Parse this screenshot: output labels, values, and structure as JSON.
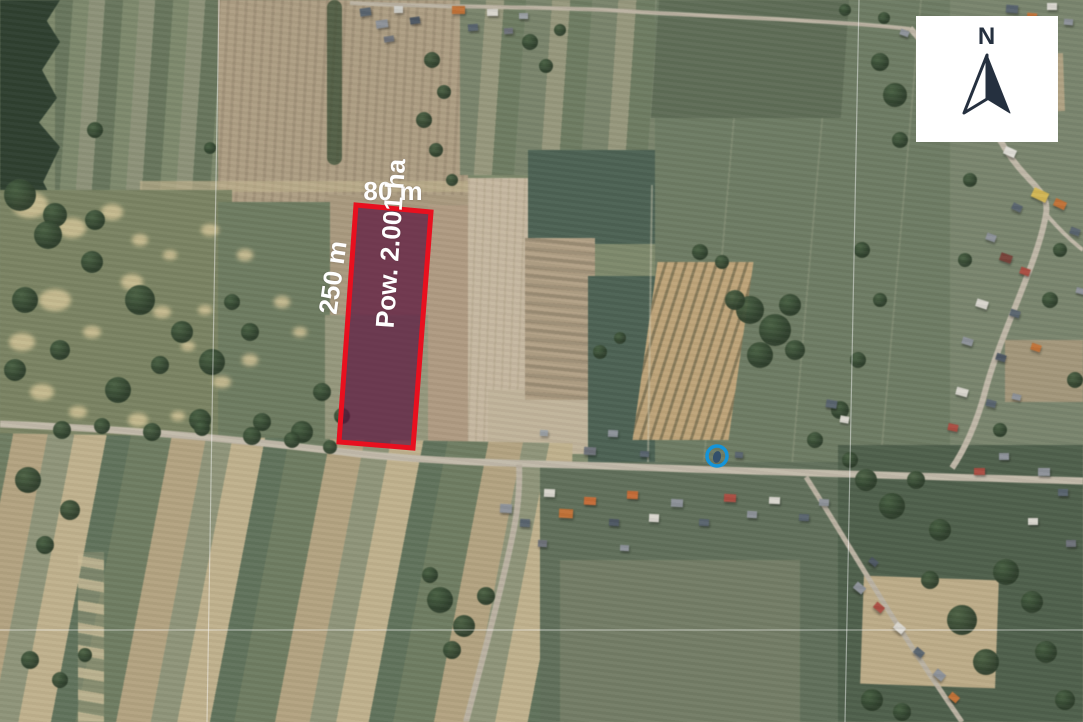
{
  "annotations": {
    "width_label": "80 m",
    "length_label": "250 m",
    "area_label": "Pow. 2.001 ha"
  },
  "compass": {
    "label": "N"
  },
  "theme": {
    "parcel_outline": "#e8101f",
    "parcel_fill": "rgba(92,22,62,0.72)",
    "marker_blue": "#1494da",
    "compass_navy": "#25303f",
    "label_white": "#ffffff",
    "road": "#c5bcaa"
  }
}
